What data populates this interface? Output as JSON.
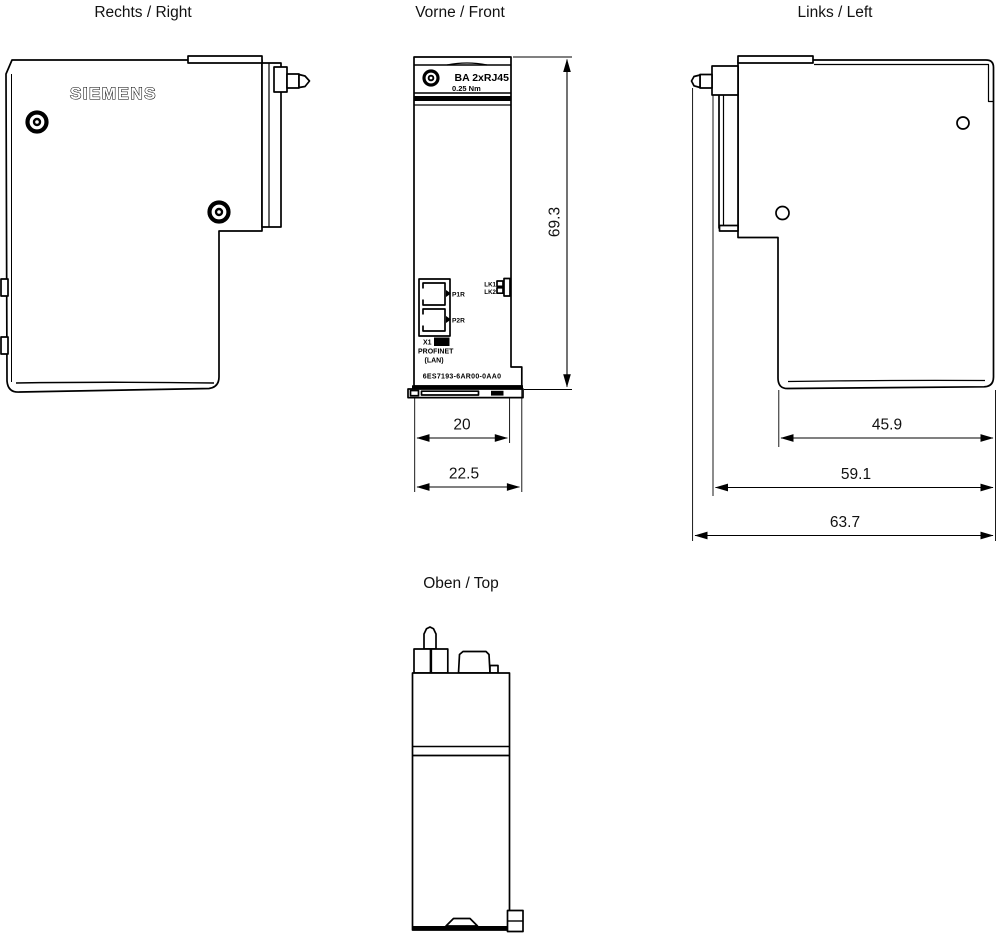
{
  "colors": {
    "ink": "#000000",
    "background": "#ffffff"
  },
  "views": {
    "right": {
      "label": "Rechts / Right",
      "brand": "SIEMENS"
    },
    "front": {
      "label": "Vorne / Front",
      "module_name": "BA 2xRJ45",
      "torque_rating": "0.25 Nm",
      "port1_label": "P1R",
      "port2_label": "P2R",
      "led1_label": "LK1",
      "led2_label": "LK2",
      "interface_label": "X1",
      "interface_type": "PN",
      "bus_label": "PROFINET",
      "lan_label": "(LAN)",
      "article_number": "6ES7193-6AR00-0AA0",
      "dim_height": "69.3",
      "dim_width_body": "20",
      "dim_width_total": "22.5"
    },
    "left": {
      "label": "Links / Left",
      "dim_depth_front": "45.9",
      "dim_depth_mid": "59.1",
      "dim_depth_total": "63.7"
    },
    "top": {
      "label": "Oben / Top"
    }
  }
}
